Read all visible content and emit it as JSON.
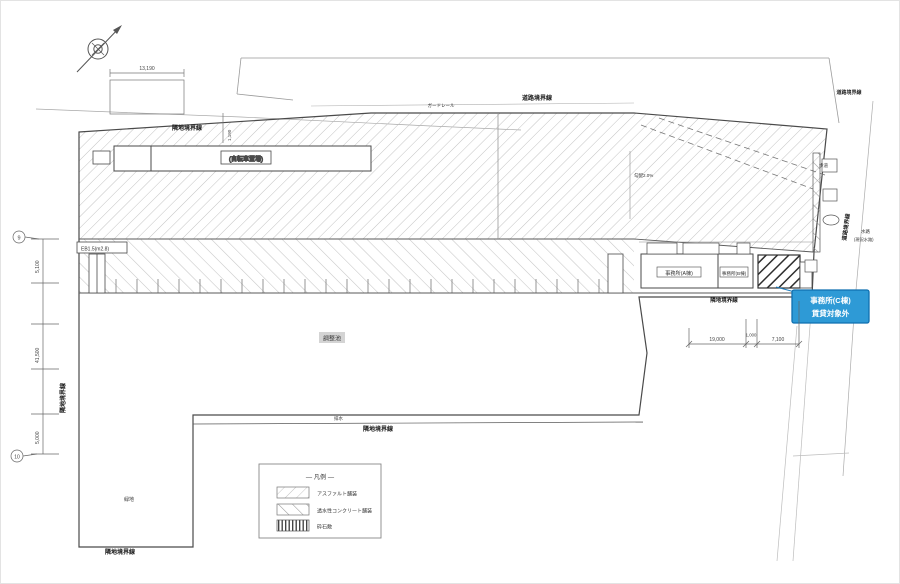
{
  "colors": {
    "line": "#4a4a4a",
    "hatch_light": "#b3b3b3",
    "hatch_mid": "#8f8f8f",
    "hatch_dark": "#3a3a3a",
    "callout_bg": "#2e9ad6",
    "callout_border": "#0f6fb0",
    "callout_text": "#ffffff",
    "pond_box_bg": "#d4d4d4"
  },
  "icons": {
    "compass": "north-arrow"
  },
  "callout": {
    "line1": "事務所(C棟)",
    "line2": "賃貸対象外"
  },
  "buildings": {
    "a": "事務所(A棟)",
    "b": "事務所(B棟)"
  },
  "site_labels": {
    "bicycle_shed": "(自転車置場)",
    "pond": "調整池",
    "drainage": "排水",
    "slope": "勾配2.0%",
    "guardrail": "ガードレール",
    "sidewalk": "歩道",
    "green": "緑地",
    "waterway1": "水路",
    "waterway2": "(現況水路)",
    "left_note": "EB1.5(m2.8)"
  },
  "boundaries": {
    "adjacent": "隣地境界線",
    "road": "道路境界線"
  },
  "dimensions": {
    "top_width": "13,190",
    "top_offset": "1,190",
    "left_top": "5,100",
    "left_mid": "41,500",
    "left_bottom": "5,000",
    "ref_top": "9",
    "ref_bottom": "10",
    "br_a": "19,000",
    "br_b": "1,000",
    "br_c": "7,100"
  },
  "legend": {
    "title": "― 凡例 ―",
    "items": [
      {
        "label": "アスファルト舗装"
      },
      {
        "label": "透水性コンクリート舗装"
      },
      {
        "label": "砕石敷"
      }
    ]
  }
}
